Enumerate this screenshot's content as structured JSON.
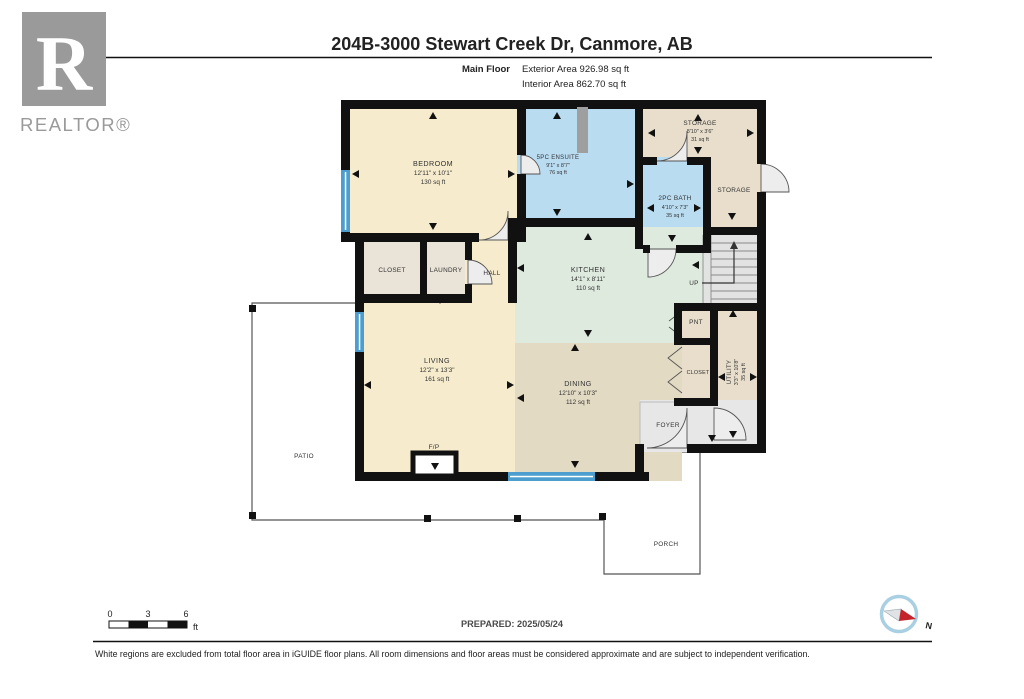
{
  "header": {
    "title": "204B-3000 Stewart Creek Dr, Canmore, AB",
    "floor_label": "Main Floor",
    "exterior_area": "Exterior Area 926.98 sq ft",
    "interior_area": "Interior Area 862.70 sq ft"
  },
  "logo": {
    "letter": "R",
    "brand": "REALTOR®"
  },
  "rooms": {
    "bedroom": {
      "name": "BEDROOM",
      "dims": "12'11\" x 10'1\"",
      "area": "130 sq ft"
    },
    "ensuite": {
      "name": "5PC ENSUITE",
      "dims": "9'1\" x 8'7\"",
      "area": "76 sq ft"
    },
    "storage": {
      "name": "STORAGE",
      "dims": "8'10\" x 3'6\"",
      "area": "31 sq ft"
    },
    "storage2": {
      "name": "STORAGE"
    },
    "bath": {
      "name": "2PC BATH",
      "dims": "4'10\" x 7'3\"",
      "area": "35 sq ft"
    },
    "kitchen": {
      "name": "KITCHEN",
      "dims": "14'1\" x 8'11\"",
      "area": "110 sq ft"
    },
    "living": {
      "name": "LIVING",
      "dims": "12'2\" x 13'3\"",
      "area": "161 sq ft"
    },
    "dining": {
      "name": "DINING",
      "dims": "12'10\" x 10'3\"",
      "area": "112 sq ft"
    },
    "utility": {
      "name": "UTILITY",
      "dims": "3'3\" x 10'8\"",
      "area": "35 sq ft"
    },
    "closet": {
      "name": "CLOSET"
    },
    "laundry": {
      "name": "LAUNDRY"
    },
    "hall": {
      "name": "HALL"
    },
    "pantry": {
      "name": "PNT"
    },
    "closet2": {
      "name": "CLOSET"
    },
    "foyer": {
      "name": "FOYER"
    },
    "fireplace": {
      "name": "F/P"
    },
    "stairs": {
      "name": "UP"
    },
    "patio": {
      "name": "PATIO"
    },
    "porch": {
      "name": "PORCH"
    }
  },
  "footer": {
    "scale": {
      "t0": "0",
      "t3": "3",
      "t6": "6",
      "unit": "ft"
    },
    "prepared": "PREPARED: 2025/05/24",
    "compass_n": "N",
    "disclaimer": "White regions are excluded from total floor area in iGUIDE floor plans. All room dimensions and floor areas must be considered approximate and are subject to independent verification."
  },
  "colors": {
    "wall": "#111111",
    "room_cream": "#f6ebcc",
    "room_blue": "#b9dcf1",
    "room_tan": "#e8decb",
    "room_tan_dark": "#e3dac3",
    "room_green": "#dfeadf",
    "room_gray": "#e7e7e7",
    "closet_fill": "#eae3d7",
    "window_blue": "#4d9ecf",
    "compass_red": "#c4242b",
    "logo_gray": "#9a9a9a"
  }
}
